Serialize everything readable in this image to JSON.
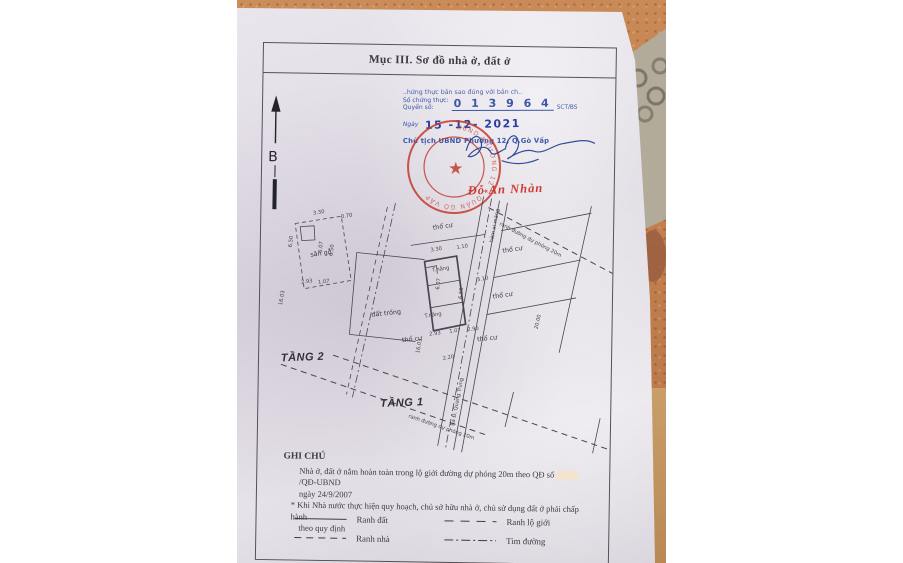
{
  "colors": {
    "seal_red": "#c23b2e",
    "stamp_blue": "#3a57a8",
    "date_blue": "#2b3f9e",
    "ink": "#3f3b45",
    "floor_orange": "#c08052",
    "paper": "#e6e2e9"
  },
  "doc": {
    "title": "Mục III. Sơ đồ nhà ở, đất ở",
    "certification": {
      "line1": "..hứng thực bản sao đúng với bản ch..",
      "so_chung_thuc_label": "Số chứng thực:",
      "quyen_so_label": "Quyển số:",
      "number": "0 1 3 9 6 4",
      "number_suffix": "SCT/BS",
      "ngay_label": "Ngày",
      "date_stamp": "15 -12- 2021",
      "authority": "Chủ tịch UBND Phường 12, Q.Gò Vấp"
    },
    "seal_text": "UBND PHƯỜNG 12 ★ QUẬN GÒ VẤP",
    "signer_name": "Đỗ An Nhàn",
    "compass": {
      "label": "B"
    },
    "plan": {
      "floor2": "TẦNG 2",
      "floor1": "TẦNG 1",
      "areas": {
        "san_go": "sân gỗ",
        "dat_trong": "đất trống",
        "tho_cu_1": "thổ cư",
        "tho_cu_2": "thổ cư",
        "tho_cu_3": "thổ cư",
        "tho_cu_4": "thổ cư",
        "tho_cu_5": "thổ cư",
        "t_nang_1": "T.nắng",
        "t_nang_2": "T.nắng"
      },
      "roads": {
        "hem": "hẻm xi măng",
        "ra_duong": "Ra Đ. Quang Trung",
        "ranh_1": "ranh đường dự phóng 20m",
        "ranh_2": "ranh đường dự phóng 20m"
      },
      "dims": {
        "sg_330": "3.30",
        "sg_070": "0.70",
        "sg_650": "6.50",
        "sg_607": "6.07",
        "sg_650b": "6.50",
        "sg_293": "2.93",
        "sg_107": "1.07",
        "sg_1603": "16.03",
        "h_330": "3.30",
        "h_110": "1.10",
        "h_607": "6.07",
        "h_650": "6.50",
        "h_293": "2.93",
        "h_107": "1.07",
        "h_290": "2.90",
        "h_310": "3.10",
        "h_2000": "20.00",
        "h_1603": "16.03",
        "h_220": "2.20"
      }
    },
    "notes": {
      "heading": "GHI CHÚ",
      "line1a": "Nhà ở, đất ở nằm hoàn toàn trong lộ giới đường dự phóng 20m theo QĐ số",
      "line1b": "/QĐ-UBND",
      "line2": "ngày 24/9/2007",
      "line3": "* Khi Nhà nước thực hiện quy hoạch, chủ sở hữu nhà ở, chủ sử dụng đất ở phải chấp hành",
      "line4": "theo quy định"
    },
    "legend": {
      "ranh_dat": "Ranh đất",
      "ranh_nha": "Ranh nhà",
      "ranh_lo_gioi": "Ranh lộ giới",
      "tim_duong": "Tim đường"
    }
  }
}
